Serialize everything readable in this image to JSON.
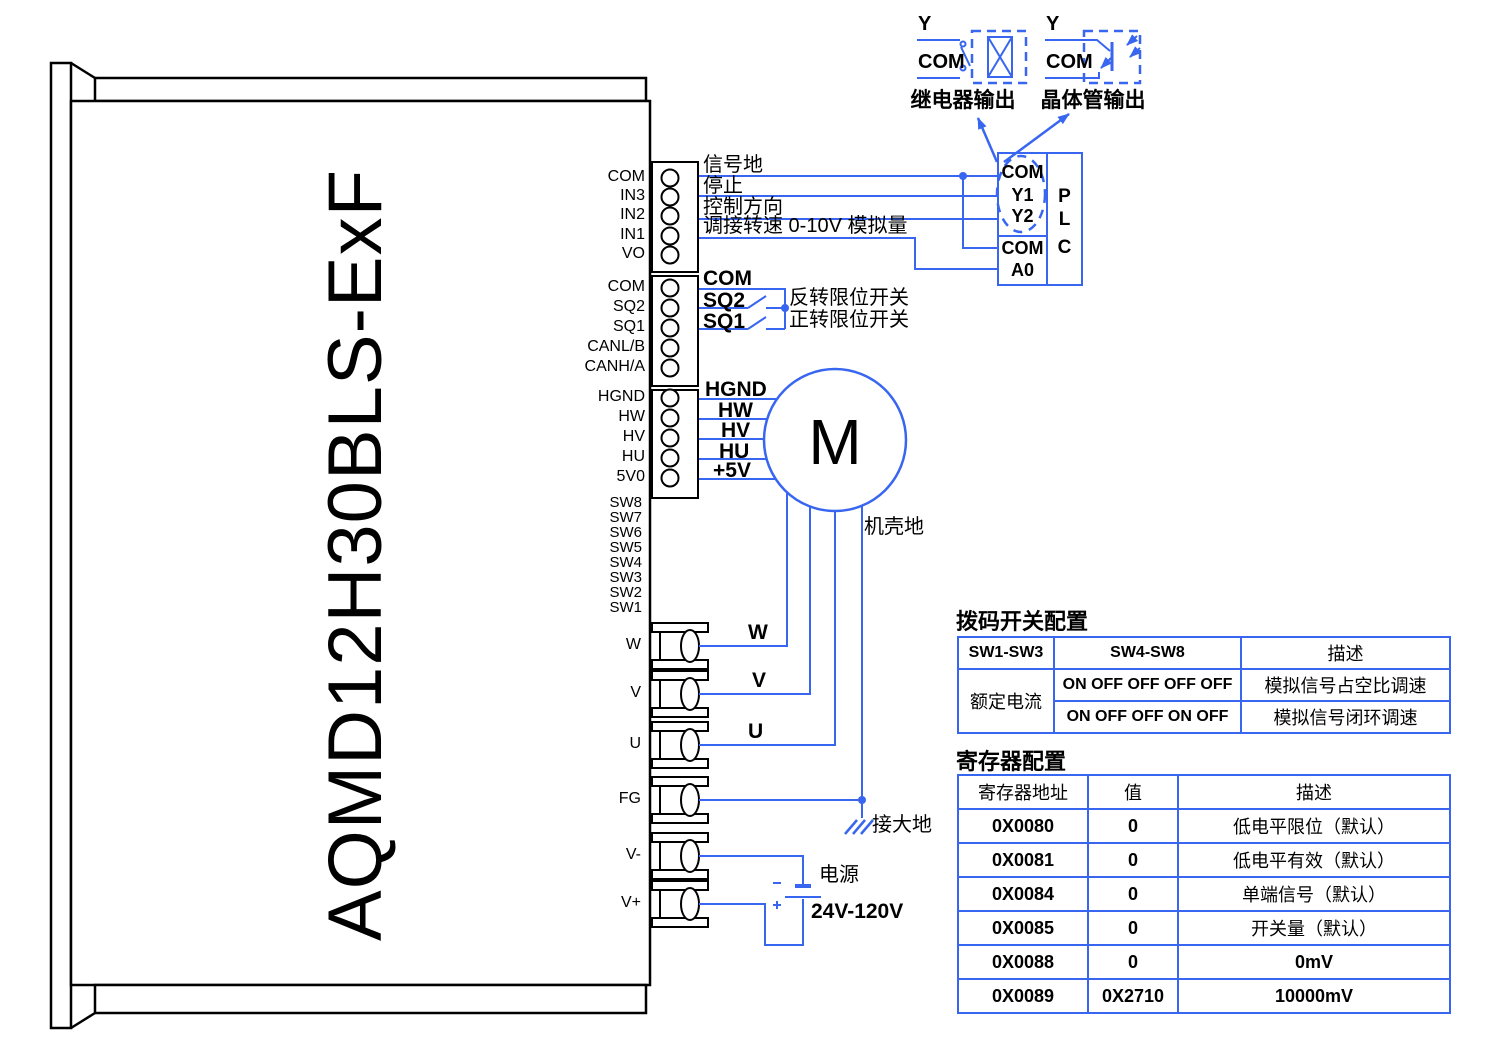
{
  "colors": {
    "wire": "#3866f0",
    "ink": "#000000"
  },
  "model": "AQMD12H30BLS-ExF",
  "pins": {
    "io": [
      "COM",
      "IN3",
      "IN2",
      "IN1",
      "VO"
    ],
    "limit": [
      "COM",
      "SQ2",
      "SQ1",
      "CANL/B",
      "CANH/A"
    ],
    "hall": [
      "HGND",
      "HW",
      "HV",
      "HU",
      "5V0"
    ],
    "dip": [
      "SW8",
      "SW7",
      "SW6",
      "SW5",
      "SW4",
      "SW3",
      "SW2",
      "SW1"
    ],
    "power": [
      "W",
      "V",
      "U",
      "FG",
      "V-",
      "V+"
    ]
  },
  "wire_labels": {
    "signal_gnd": "信号地",
    "stop": "停止",
    "direction": "控制方向",
    "speed": "调接转速 0-10V  模拟量",
    "com": "COM",
    "sq2": "SQ2",
    "sq1": "SQ1",
    "reverse_limit": "反转限位开关",
    "forward_limit": "正转限位开关",
    "hgnd": "HGND",
    "hw": "HW",
    "hv": "HV",
    "hu": "HU",
    "p5v": "+5V",
    "w": "W",
    "v": "V",
    "u": "U",
    "chassis_gnd": "机壳地",
    "earth_gnd": "接大地"
  },
  "plc": {
    "com_top": "COM",
    "y1": "Y1",
    "y2": "Y2",
    "com_bottom": "COM",
    "a0": "A0",
    "p": "P",
    "l": "L",
    "c": "C"
  },
  "outputs": {
    "relay": {
      "y": "Y",
      "com": "COM",
      "caption": "继电器输出"
    },
    "transistor": {
      "y": "Y",
      "com": "COM",
      "caption": "晶体管输出"
    }
  },
  "motor": {
    "letter": "M"
  },
  "supply": {
    "name": "电源",
    "range": "24V-120V",
    "minus": "-",
    "plus": "+"
  },
  "dip_table": {
    "title": "拨码开关配置",
    "col1": "SW1-SW3",
    "col2": "SW4-SW8",
    "col3": "描述",
    "group": "额定电流",
    "rows": [
      {
        "sw": "ON OFF OFF OFF OFF",
        "desc": "模拟信号占空比调速"
      },
      {
        "sw": "ON OFF OFF ON  OFF",
        "desc": "模拟信号闭环调速"
      }
    ]
  },
  "reg_table": {
    "title": "寄存器配置",
    "col1": "寄存器地址",
    "col2": "值",
    "col3": "描述",
    "rows": [
      [
        "0X0080",
        "0",
        "低电平限位（默认）"
      ],
      [
        "0X0081",
        "0",
        "低电平有效（默认）"
      ],
      [
        "0X0084",
        "0",
        "单端信号（默认）"
      ],
      [
        "0X0085",
        "0",
        "开关量（默认）"
      ],
      [
        "0X0088",
        "0",
        "0mV"
      ],
      [
        "0X0089",
        "0X2710",
        "10000mV"
      ]
    ]
  }
}
